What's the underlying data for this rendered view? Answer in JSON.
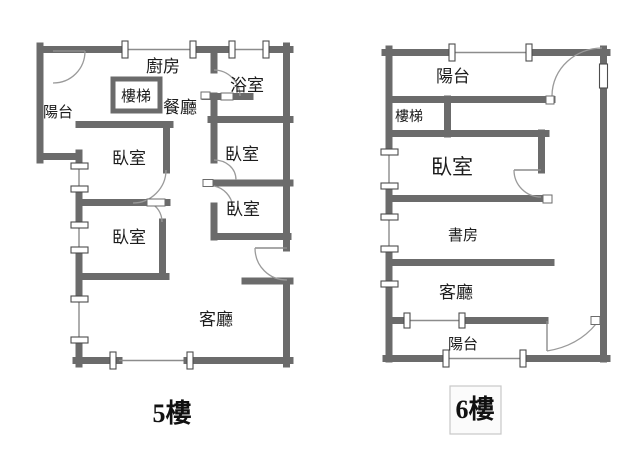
{
  "figure": {
    "type": "floor-plan-pair",
    "width": 640,
    "height": 461
  },
  "floors": {
    "f5": {
      "title": "5樓",
      "rooms": {
        "balcony": "陽台",
        "kitchen": "廚房",
        "stairs": "樓梯",
        "dining": "餐廳",
        "bathroom": "浴室",
        "bedroom_left_top": "臥室",
        "bedroom_left_bottom": "臥室",
        "bedroom_mid_top": "臥室",
        "bedroom_mid_bottom": "臥室",
        "living": "客廳"
      }
    },
    "f6": {
      "title": "6樓",
      "rooms": {
        "balcony_top": "陽台",
        "stairs": "樓梯",
        "bedroom": "臥室",
        "study": "書房",
        "living": "客廳",
        "balcony_bottom": "陽台"
      }
    }
  },
  "colors": {
    "wall": "#6b6b6b",
    "thin_line": "#8c8c8c",
    "marker_border": "#4d4d4d",
    "text": "#1c1c1c",
    "floor6_box_border": "#c8c8c8",
    "background": "#ffffff"
  }
}
